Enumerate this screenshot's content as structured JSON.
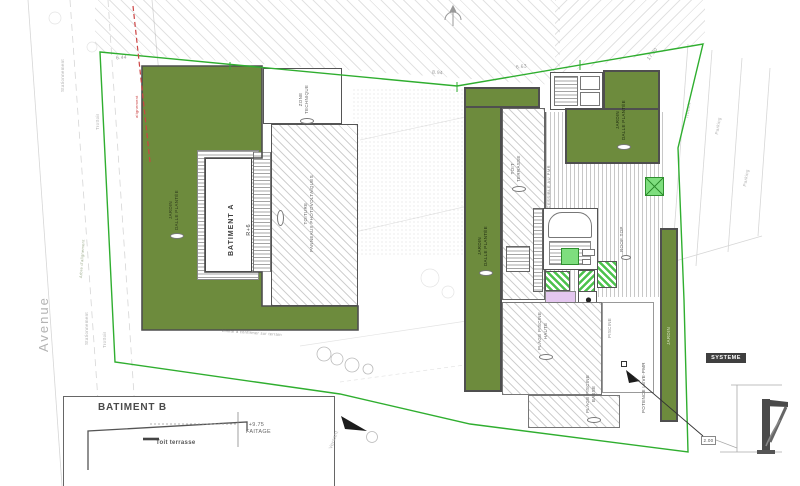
{
  "plan": {
    "batiment_a": {
      "name": "BATIMENT A",
      "level": "R+6"
    },
    "batiment_b": {
      "name": "BATIMENT B",
      "faitage_value": "+9.75",
      "faitage_label": "FAITAGE",
      "toit_terrasse": "Toit terrasse"
    },
    "labels": {
      "jardin_dalle_plantee": "JARDIN\nDALLE PLANTÉE",
      "zone_technique": "ZONE\nTECHNIQUE",
      "toiture_pv": "TOITURE\nPANNEAUX PHOTOVOLTAÏQUES",
      "toit_terrasse": "TOIT\nTERRASSE",
      "acces_pmr": "ACCESSIBLE AU PMR",
      "roof_top": "ROOF TOP",
      "plage_piscine_haute": "PLAGE PISCINE\nHAUTE",
      "plage_piscine_basse": "PLAGE PISCINE\nBASSE",
      "piscine": "PISCINE",
      "jardin": "JARDIN",
      "potence": "POTENCE LEVE-PMR",
      "systeme": "SYSTEME",
      "versant": "Versant",
      "limite": "Limite à confirmer sur terrain",
      "alignement": "alignement",
      "arbre_alignement": "Arbre d'alignement"
    },
    "streets": {
      "avenue": "Avenue",
      "stationnement": "Stationnement",
      "trottoir": "Trottoir",
      "parking": "Parking"
    },
    "dimensions": {
      "d_644": "6.44",
      "d_894": "8.94",
      "d_663": "6.63",
      "d_1730": "17.30",
      "d_200": "2.00"
    },
    "colors": {
      "olive": "#6d8b3d",
      "bright_green": "#7ede7e",
      "violet": "#e4c7ef",
      "boundary_green": "#2fae2f",
      "alignment_red": "#cc4444",
      "wall_gray": "#4f4f4f"
    }
  }
}
